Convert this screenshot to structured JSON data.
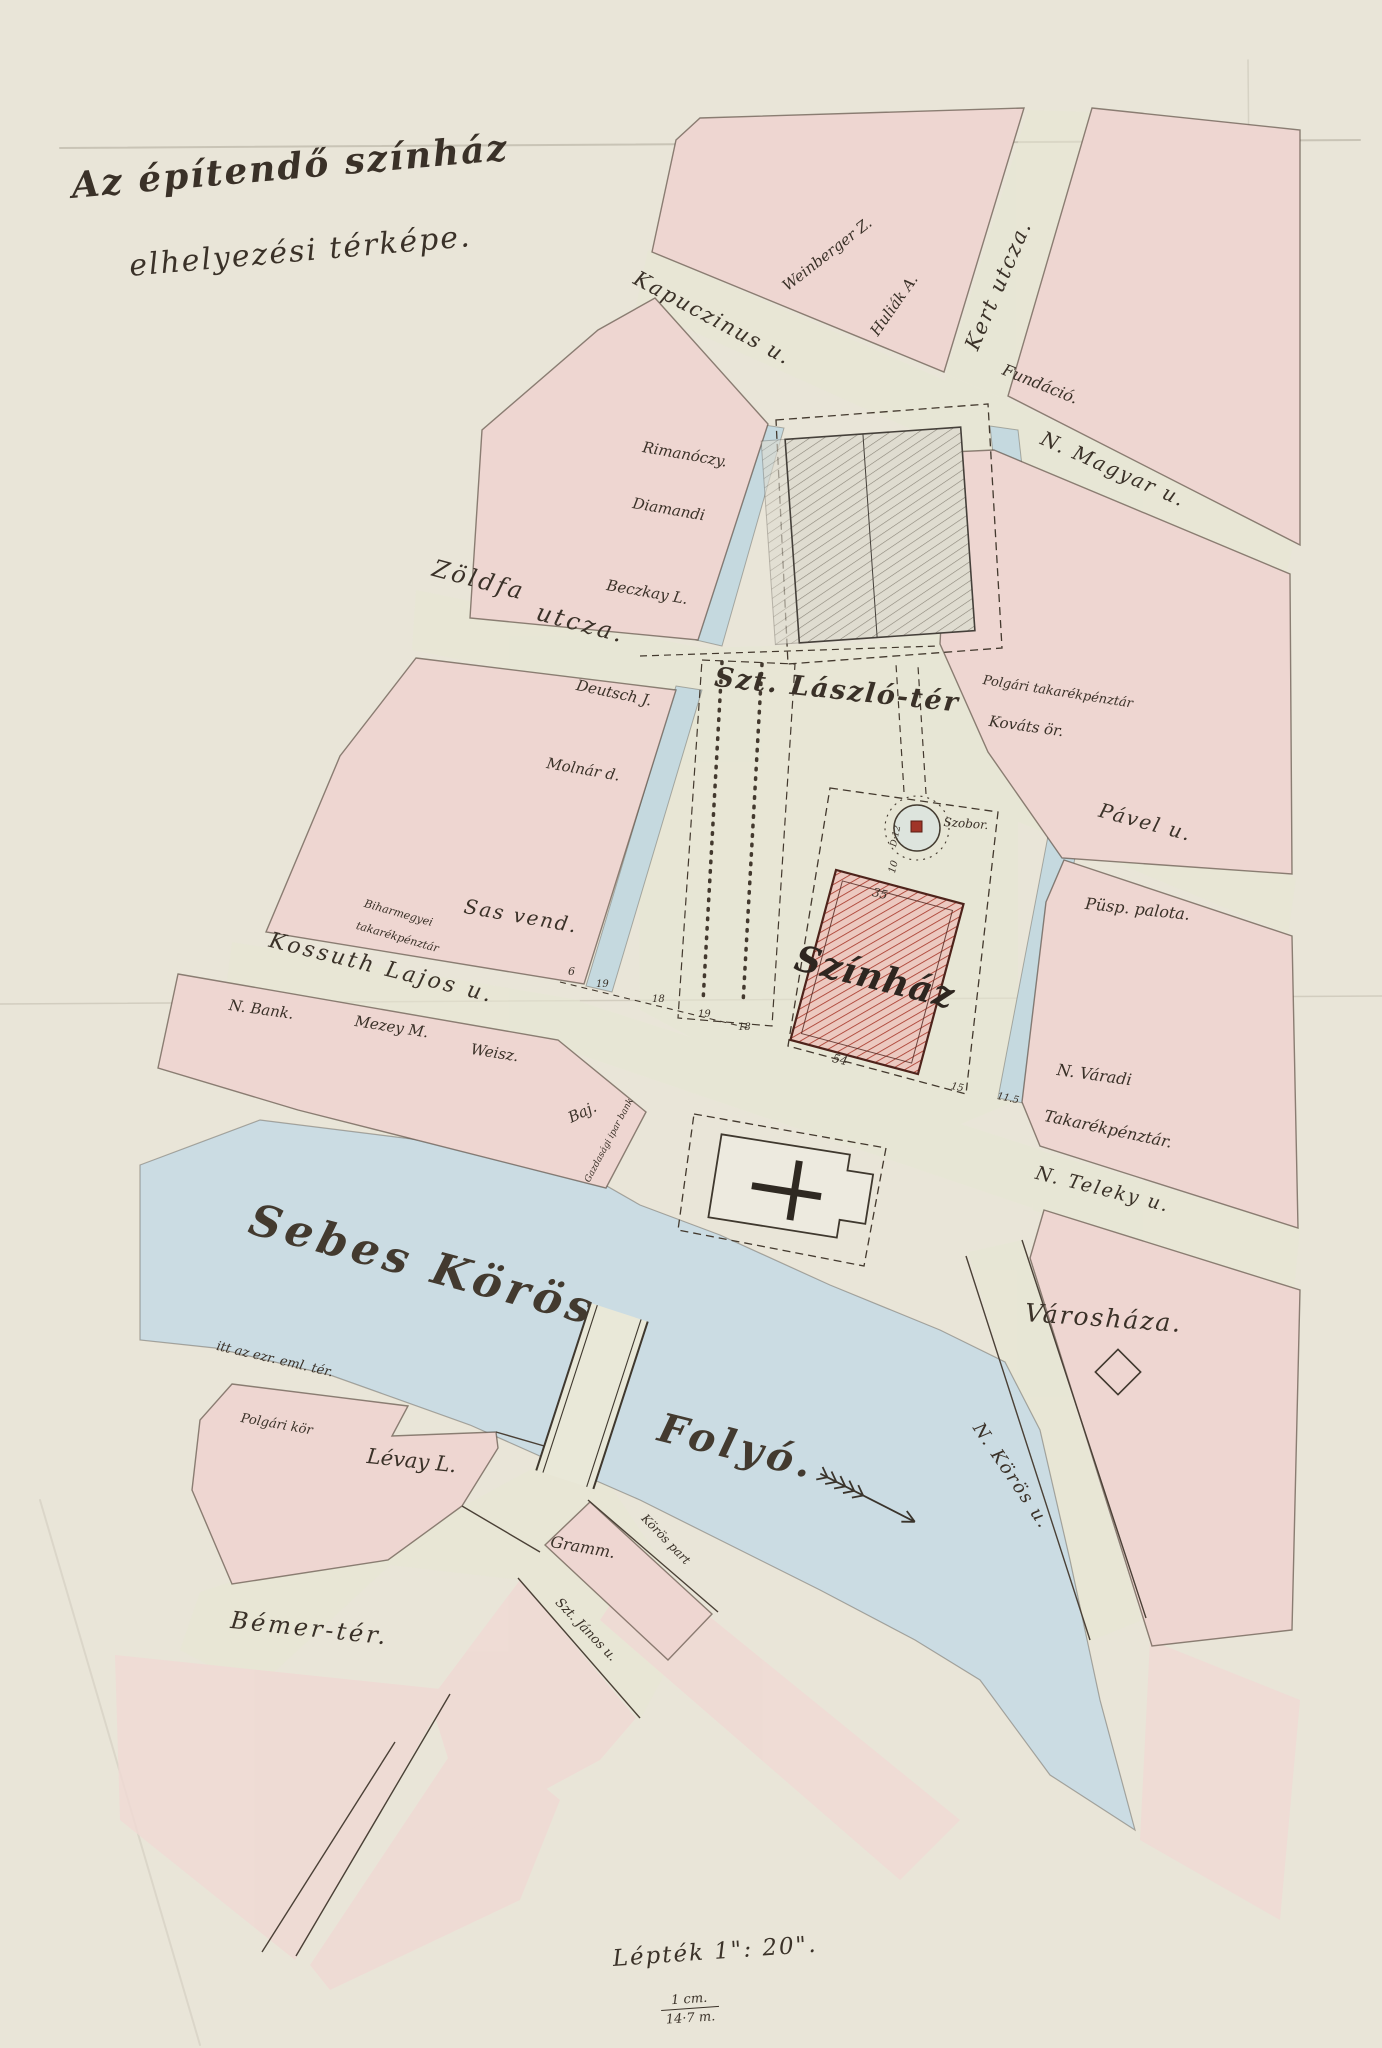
{
  "title": {
    "line1": "Az építendő színház",
    "line2": "elhelyezési térképe."
  },
  "scale": {
    "label": "Lépték 1\": 20\".",
    "numerator": "1 cm.",
    "denominator": "14·7 m."
  },
  "streets": {
    "kapuczinus": "Kapuczinus u.",
    "kert": "Kert utcza.",
    "n_magyar": "N. Magyar u.",
    "zoldfa_1": "Zöldfa",
    "zoldfa_2": "utcza.",
    "szt_laszlo_ter": "Szt. László-tér",
    "pavel": "Pável u.",
    "kossuth": "Kossuth Lajos u.",
    "n_teleky": "N. Teleky u.",
    "n_koros": "N. Körös u.",
    "szt_janos": "Szt. János u.",
    "koros_part": "Körös part",
    "bemer_ter": "Bémer-tér.",
    "ezredev": "itt az ezr. eml. tér."
  },
  "river": {
    "name": "Sebes Körös",
    "type": "Folyó."
  },
  "buildings": {
    "weinberger": "Weinberger Z.",
    "huliak": "Huliák A.",
    "fundacio": "Fundáció.",
    "rimanoczy": "Rimanóczy.",
    "diamandi": "Diamandi",
    "beczkay": "Beczkay L.",
    "deutsch": "Deutsch J.",
    "molnar": "Molnár d.",
    "bihar_1": "Biharmegyei",
    "bihar_2": "takarékpénztár",
    "sas_vend": "Sas vend.",
    "polgari_tak": "Polgári takarékpénztár",
    "kovats": "Kováts ör.",
    "pusp_palota": "Püsp. palota.",
    "n_varadi_1": "N. Váradi",
    "n_varadi_2": "Takarékpénztár.",
    "varoshaza": "Városháza.",
    "n_bank": "N. Bank.",
    "mezey": "Mezey M.",
    "weisz": "Weisz.",
    "baj": "Baj.",
    "baj_sub": "Gazdasági ipar bank",
    "levay": "Lévay L.",
    "polgari_kor": "Polgári kör",
    "gramm": "Gramm.",
    "szinhaz": "Színház",
    "szobor": "Szobor."
  },
  "dimensions": {
    "top": "35",
    "bottom": "54",
    "to_statue": "10",
    "right": "15",
    "right2": "11.5",
    "statue_d": "D:12",
    "c1": "6",
    "c2": "19",
    "c3": "18",
    "c4": "19",
    "c5": "18"
  },
  "colors": {
    "paper": "#e9e5d8",
    "block_pink": "#eed6d1",
    "water": "#cbdce3",
    "street": "#e8e8d5",
    "ink": "#3a3128",
    "theatre_red": "#a93b2d"
  }
}
